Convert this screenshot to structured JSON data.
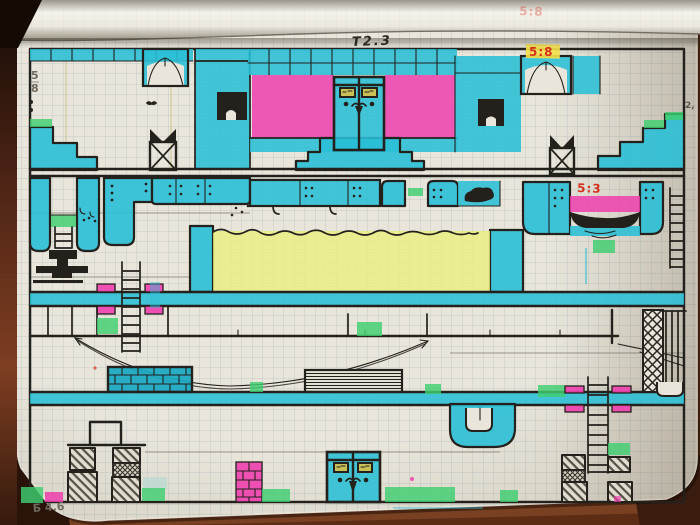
{
  "annotations": {
    "title_code": "Т2.3",
    "fraction_top_left": {
      "numerator": "5",
      "denominator": "8"
    },
    "code_top_right": "5:8",
    "code_mid_right": "5:3",
    "note_bottom_left": "Б 4.6",
    "margin_mark": "2,",
    "roll_showthrough": "5:8"
  },
  "palette": {
    "paper": "#e9e5da",
    "grid_line": "#7fa3ab",
    "ink": "#24211c",
    "pencil": "#6f695d",
    "marker_cyan": "#2abfd6",
    "marker_cyan_deep": "#17a8c2",
    "marker_magenta": "#ee3fae",
    "marker_yellow": "#eaf07d",
    "marker_green": "#3fce70",
    "annotation_red": "#d6301d",
    "highlight_yellow": "#f4e14b",
    "desk_wood": "#6b3318",
    "desk_dark": "#22130a",
    "page_roll": "#f4f1ea"
  }
}
